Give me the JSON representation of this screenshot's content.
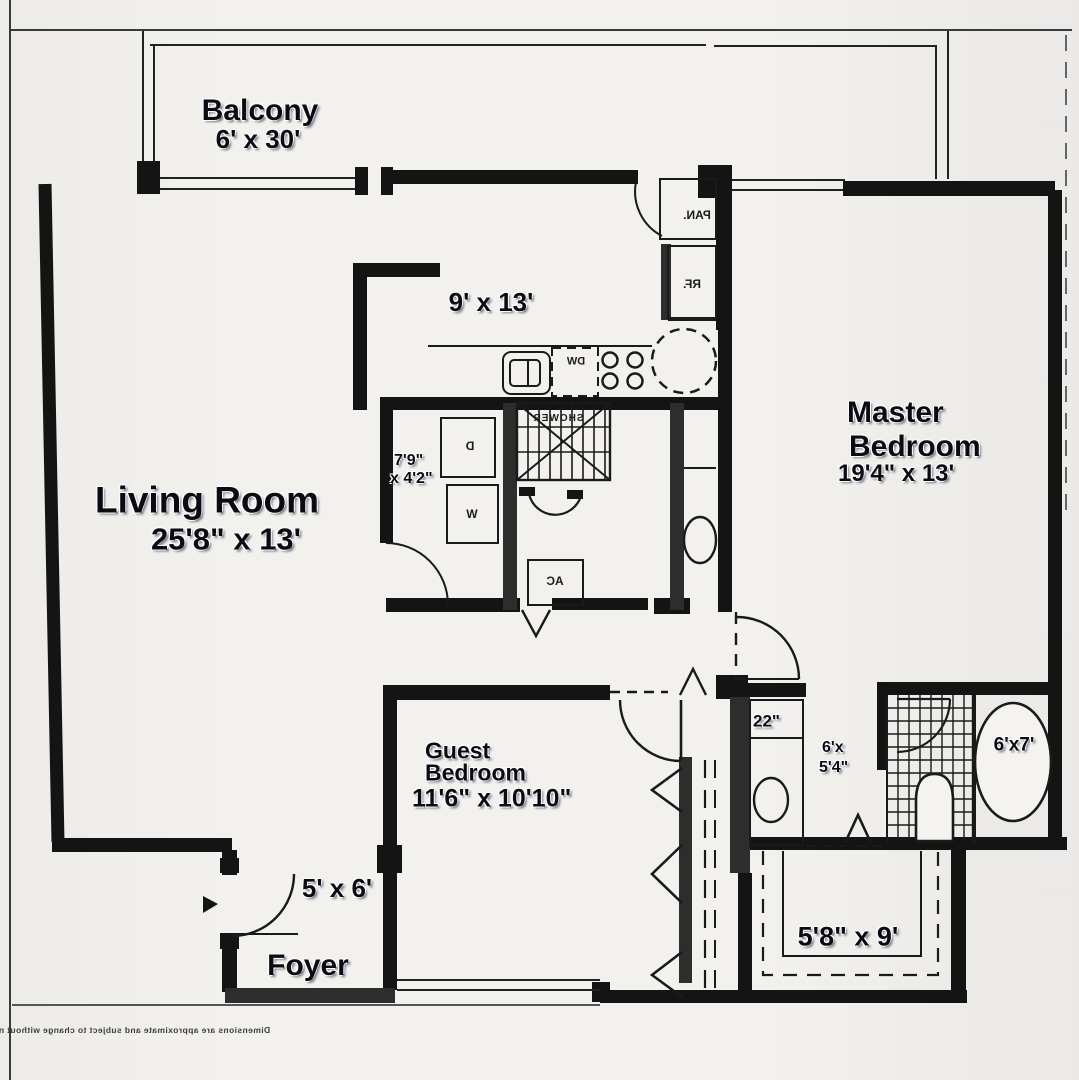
{
  "page": {
    "background": "#f3f1ee",
    "line_color": "#1a1a1a",
    "wall_color": "#141414",
    "hatch_wall_color": "#2d2d2d",
    "label_color": "#0b0b14"
  },
  "disclaimer": "Dimensions are approximate and subject to change without notice.",
  "rooms": {
    "balcony": {
      "name": "Balcony",
      "dimensions": "6' x 30'"
    },
    "kitchen": {
      "dimensions": "9' x 13'"
    },
    "living_room": {
      "name": "Living Room",
      "dimensions": "25'8\" x 13'"
    },
    "master_bedroom": {
      "name_line1": "Master",
      "name_line2": "Bedroom",
      "dimensions": "19'4\" x 13'"
    },
    "guest_bedroom": {
      "name_line1": "Guest",
      "name_line2": "Bedroom",
      "dimensions": "11'6\" x 10'10\""
    },
    "foyer": {
      "name": "Foyer",
      "dimensions": "5' x 6'"
    },
    "laundry_closet": {
      "dimensions_line1": "7'9\"",
      "dimensions_line2": "x 4'2\""
    },
    "hall_closet": {
      "dimensions": "22\""
    },
    "master_bath": {
      "dimensions_line1": "6'x",
      "dimensions_line2": "5'4\""
    },
    "tub_room": {
      "dimensions": "6'x7'"
    },
    "walk_in_closet": {
      "dimensions": "5'8\" x 9'"
    }
  },
  "fixtures": {
    "pantry": "PAN.",
    "refrigerator": "RF.",
    "dishwasher": "DW",
    "shower": "SHOWER",
    "dryer": "D",
    "washer": "W",
    "air_conditioner": "AC"
  }
}
